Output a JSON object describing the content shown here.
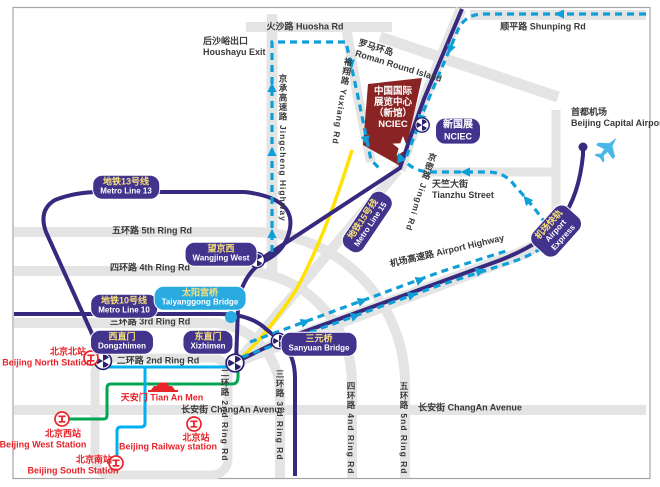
{
  "colors": {
    "metro_line_purple": "#372a7e",
    "badge_purple": "#42338c",
    "badge_light_blue": "#29abe2",
    "route_dashed_blue": "#0f9fd8",
    "route_green": "#00a651",
    "route_cyan": "#00b0f0",
    "route_yellow": "#ffe200",
    "venue_dark_red": "#8a2424",
    "station_red": "#e8232a",
    "road_gray": "#e4e4e4"
  },
  "roads": {
    "huosha": "火沙路 Huosha Rd",
    "shunping": "顺平路 Shunping Rd",
    "houshayu_exit_zh": "后沙峪出口",
    "houshayu_exit_en": "Houshayu Exit",
    "roman_island_zh": "罗马环岛",
    "roman_island_en": "Roman Round Island",
    "jingcheng_highway": "京承高速路 Jingcheng Highway",
    "yuxiang": "裕翔路 Yuxiang Rd",
    "jingmi": "京密路 Jingmi Rd",
    "tianzhu_zh": "天竺大街",
    "tianzhu_en": "Tianzhu Street",
    "airport_highway": "机场高速路 Airport Highway",
    "ring5_h": "五环路 5th Ring Rd",
    "ring4_h": "四环路 4th Ring Rd",
    "ring3_h": "三环路 3rd Ring Rd",
    "ring2_h": "二环路 2nd Ring Rd",
    "ring2_v": "二环路 2nd Ring Rd",
    "ring3_v": "三环路 3rd Ring Rd",
    "ring4_v": "四环路 4nd Ring Rd",
    "ring5_v": "五环路 5nd Ring Rd",
    "changan_west": "长安街 ChangAn Avenue",
    "changan_east": "长安街 ChangAn Avenue"
  },
  "metro": {
    "line13": {
      "zh": "地铁13号线",
      "en": "Metro Line 13"
    },
    "line10": {
      "zh": "地铁10号线",
      "en": "Metro Line 10"
    },
    "line15": {
      "zh": "地铁15号线",
      "en": "Metro Line 15"
    },
    "airport_express": {
      "zh": "机场快轨",
      "en1": "Airport",
      "en2": "Express"
    },
    "wangjing_west": {
      "zh": "望京西",
      "en": "Wangjing West"
    },
    "taiyanggong": {
      "zh": "太阳宫桥",
      "en": "Taiyanggong Bridge"
    },
    "dongzhimen": {
      "zh": "西直门",
      "en": "Dongzhimen"
    },
    "xizhimen": {
      "zh": "东直门",
      "en": "Xizhimen"
    },
    "sanyuan": {
      "zh": "三元桥",
      "en": "Sanyuan Bridge"
    },
    "nciec_station": {
      "zh": "新国展",
      "en": "NCIEC"
    }
  },
  "venue": {
    "line1": "中国国际",
    "line2": "展览中心",
    "line3": "（新馆）",
    "line4": "NCIEC"
  },
  "stations": {
    "north": {
      "zh": "北京北站",
      "en": "Beijing North Station"
    },
    "west": {
      "zh": "北京西站",
      "en": "Beijing West Station"
    },
    "south": {
      "zh": "北京南站",
      "en": "Beijing South Station"
    },
    "railway": {
      "zh": "北京站",
      "en": "Beijing Railway station"
    }
  },
  "landmarks": {
    "tiananmen": "天安门 Tian An Men",
    "capital_airport_zh": "首都机场",
    "capital_airport_en": "Beijing Capital Airport"
  }
}
